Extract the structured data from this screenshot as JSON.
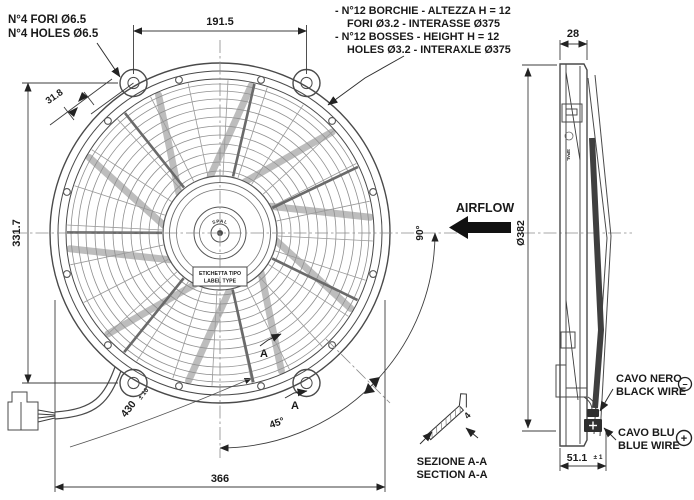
{
  "front_note": {
    "line1": "N°4 FORI Ø6.5",
    "line2": "N°4 HOLES Ø6.5"
  },
  "boss_note": {
    "line1": "- N°12 BORCHIE - ALTEZZA H = 12",
    "line2": "FORI Ø3.2 - INTERASSE Ø375",
    "line3": "- N°12 BOSSES - HEIGHT H = 12",
    "line4": "HOLES Ø3.2 - INTERAXLE Ø375"
  },
  "dims": {
    "top_width": "191.5",
    "left_height": "331.7",
    "bottom_width": "366",
    "tab_offset": "31.8",
    "wire_length": "430",
    "wire_tol": "± 10",
    "angle_45": "45°",
    "angle_90": "90°",
    "side_depth": "28",
    "fan_diameter": "Ø382",
    "bracket_depth": "51.1",
    "bracket_tol": "± 1",
    "section_thickness": "4"
  },
  "labels": {
    "airflow": "AIRFLOW",
    "patented": "PATENTED",
    "logo": "SPAL",
    "label_box_line1": "ETICHETTA TIPO",
    "label_box_line2": "LABEL TYPE",
    "section_mark": "A",
    "section_title_it": "SEZIONE A-A",
    "section_title_en": "SECTION A-A",
    "black_wire_it": "CAVO NERO",
    "black_wire_en": "BLACK WIRE",
    "blue_wire_it": "CAVO BLU",
    "blue_wire_en": "BLUE WIRE",
    "minus_symbol": "−",
    "plus_symbol": "+"
  },
  "colors": {
    "ink": "#1a1a1a",
    "line": "#3c3c3c",
    "solid_fill": "#111111",
    "background": "#ffffff"
  }
}
